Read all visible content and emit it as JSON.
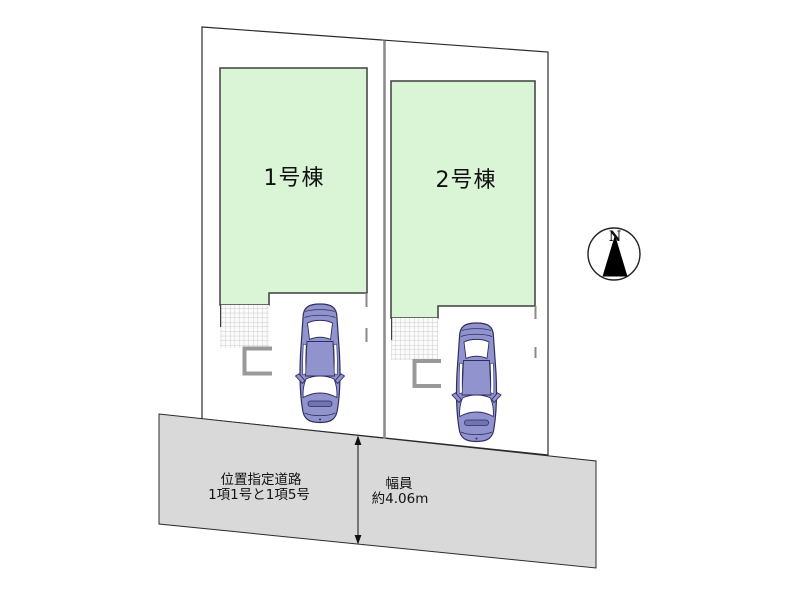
{
  "plan": {
    "buildings": [
      {
        "label": "1号棟"
      },
      {
        "label": "2号棟"
      }
    ],
    "road": {
      "name_line1": "位置指定道路",
      "name_line2": "1項1号と1項5号",
      "width_title": "幅員",
      "width_value": "約4.06m"
    },
    "compass": {
      "north_label": "N"
    },
    "colors": {
      "building_fill": "#d9f5d5",
      "building_stroke": "#3f3f3f",
      "road_fill": "#d9d9d9",
      "lot_outline": "#2b2b2b",
      "lot_divider": "#8c8c8c",
      "car_body": "#9193ce",
      "porch": "#999999"
    }
  }
}
